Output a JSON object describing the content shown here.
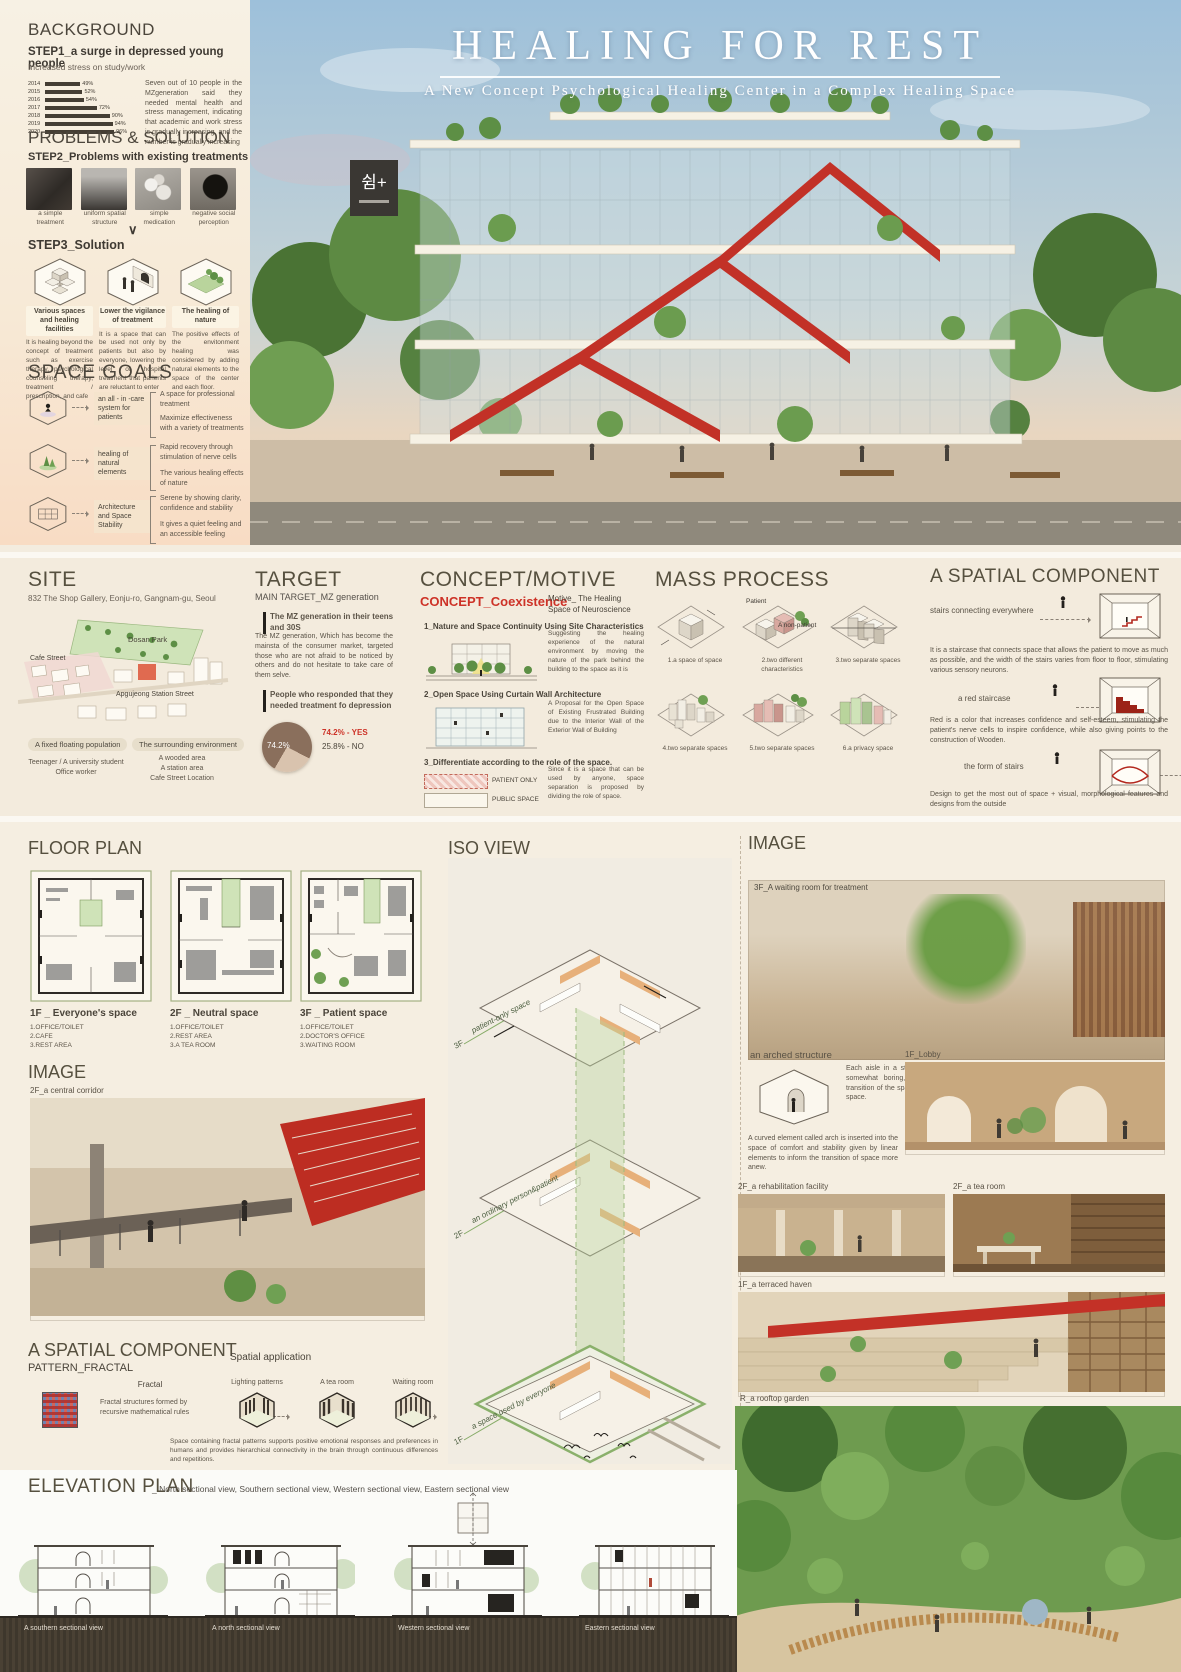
{
  "hero": {
    "title": "HEALING FOR REST",
    "subtitle": "A New Concept Psychological Healing Center in a Complex Healing Space",
    "sign_text": "쉼+"
  },
  "background": {
    "heading": "BACKGROUND",
    "step_title": "STEP1_a surge in depressed young people",
    "step_sub": "Increased stress on study/work",
    "body": "Seven out of 10 people in the MZgeneration said they needed mental health and stress management, indicating that academic and work stress is gradually increasing, and the number is gradually increasing",
    "chart": {
      "years": [
        "2014",
        "2015",
        "2016",
        "2017",
        "2018",
        "2019",
        "2020"
      ],
      "values": [
        "49%",
        "52%",
        "54%",
        "72%",
        "90%",
        "94%",
        "96%"
      ]
    }
  },
  "problems": {
    "heading": "PROBLEMS & SOLUTION",
    "step_title": "STEP2_Problems with existing treatments",
    "items": [
      {
        "label": "a simple treatment"
      },
      {
        "label": "uniform spatial structure"
      },
      {
        "label": "simple medication"
      },
      {
        "label": "negative social perception"
      }
    ]
  },
  "solution": {
    "step_title": "STEP3_Solution",
    "columns": [
      {
        "title": "Various spaces and healing facilities",
        "body": "It is healing beyond the concept of treatment such as exercise therapy, psychological counseling therapy, treatment / prescription, and cafe"
      },
      {
        "title": "Lower the vigilance of treatment",
        "body": "It is a space that can be used not only by patients but also by everyone, lowering the level of hospital treatment that parients are reluctant to enter"
      },
      {
        "title": "The healing of nature",
        "body": "The positive effects of the envitonment healing was considered by adding natural elements to the space of the center and each floor."
      }
    ]
  },
  "space_goals": {
    "heading": "SPACE GOALS",
    "rows": [
      {
        "label": "an all - in -care system for patients",
        "point1": "A space for professional treatment",
        "point2": "Maximize effectiveness with a variety of treatments"
      },
      {
        "label": "healing of natural elements",
        "point1": "Rapid recovery through stimulation of nerve cells",
        "point2": "The various healing effects of nature"
      },
      {
        "label": "Architecture and Space Stability",
        "point1": "Serene by showing clarity, confidence and stability",
        "point2": "It gives a quiet feeling and an accessible feeling"
      }
    ]
  },
  "site": {
    "heading": "SITE",
    "address": "832 The Shop Gallery, Eonju-ro, Gangnam-gu, Seoul",
    "map": {
      "park": "Dosan Park",
      "cafe": "Cafe Street",
      "station": "Apgujeong Station Street"
    },
    "tag1": "A fixed floating population",
    "tag2": "The surrounding environment",
    "note1": "Teenager / A university student Office worker",
    "note2": "A wooded area\nA station area\nCafe Street Location"
  },
  "target": {
    "heading": "TARGET",
    "sub": "MAIN TARGET_MZ generation",
    "point1": "The MZ generation in their teens and 30S",
    "body1": "The MZ generation, Which has become the mainsta of the consumer market, targeted those who are not afraid to be noticed by others and do not hesitate to take care of them selve.",
    "point2": "People who responded that they needed treatment fo depression",
    "pie": {
      "pct_label": "74.2%",
      "yes": "74.2% - YES",
      "no": "25.8% - NO"
    }
  },
  "concept": {
    "heading": "CONCEPT/MOTIVE",
    "concept_label": "CONCEPT_Coexistence",
    "motive_label": "Motive_ The Healing Space of Neuroscience",
    "item1_title": "1_Nature and Space Continuity Using Site Characteristics",
    "item1_body": "Suggesting the healing experience of the natural environment by moving the nature of the park behind the building to the space as it is",
    "item2_title": "2_Open Space Using Curtain Wall Architecture",
    "item2_body": "A Proposal for the Open Space of Existing Frustrated Building due to the Interior Wall of the Exterior Wall of Building",
    "item3_title": "3_Differentiate according to the role of the space.",
    "item3_body": "Since it is a space that can be used by anyone, space separation is proposed by dividing the role of space.",
    "item3_row1": "PATIENT ONLY",
    "item3_row2": "PUBLIC SPACE"
  },
  "mass": {
    "heading": "MASS PROCESS",
    "steps": [
      "1.a space of space",
      "2.two different characteristics",
      "3.two separate spaces",
      "4.two separate spaces",
      "5.two separate spaces",
      "6.a privacy space"
    ],
    "ann1": "Patient",
    "ann2": "A non-patient"
  },
  "spatial": {
    "heading": "A SPATIAL COMPONENT",
    "row1_label": "stairs connecting everywhere",
    "row1_body": "It is a staircase that connects space that allows the patient to move as much as possible, and the width of the stairs varies from floor to floor, stimulating various sensory neurons.",
    "row2_label": "a red staircase",
    "row2_body": "Red is a color that increases confidence and self-esteem, stimulating the patient's nerve cells to inspire confidence, while also giving points to the construction of Wooden.",
    "row3_label": "the form of stairs",
    "row3_body": "Design to get the most out of space + visual, morphological features and designs from the outside"
  },
  "floor_plan": {
    "heading": "FLOOR PLAN",
    "plans": [
      {
        "title": "1F _ Everyone's space",
        "rooms": "1.OFFICE/TOILET\n2.CAFE\n3.REST AREA"
      },
      {
        "title": "2F _ Neutral space",
        "rooms": "1.OFFICE/TOILET\n2.REST AREA\n3.A TEA ROOM"
      },
      {
        "title": "3F _ Patient space",
        "rooms": "1.OFFICE/TOILET\n2.DOCTOR'S OFFICE\n3.WAITING ROOM"
      }
    ]
  },
  "image_left": {
    "heading": "IMAGE",
    "caption": "2F_a central corridor"
  },
  "iso": {
    "heading": "ISO VIEW",
    "floors": [
      {
        "num": "3F",
        "label": "patient-only space"
      },
      {
        "num": "2F",
        "label": "an ordinary person&patient"
      },
      {
        "num": "1F",
        "label": "a space used by everyone"
      }
    ]
  },
  "fractal": {
    "heading": "A SPATIAL COMPONENT",
    "sub": "PATTERN_FRACTAL",
    "label": "Fractal",
    "desc": "Fractal structures formed by recursive mathematical rules",
    "app_title": "Spatial application",
    "apps": [
      "Lighting patterns",
      "A tea room",
      "Waiting room"
    ],
    "body": "Space containing fractal patterns supports positive emotional responses and preferences in humans and provides hierarchical connectivity in the brain through continuous differences and repetitions."
  },
  "image_right": {
    "heading": "IMAGE",
    "waiting": "3F_A waiting room for treatment",
    "arched": "an arched structure",
    "arched_body": "Each aisle in a straight space, which can be somewhat boring, is arched to inform the transition of the space and give a new sense of space.",
    "arched_body2": "A curved element called arch is inserted into the space of comfort and stability given by linear elements to inform the transition of space more anew.",
    "lobby": "1F_Lobby",
    "rehab": "2F_a rehabilitation facility",
    "tearoom": "2F_a tea room",
    "terraced": "1F_a terraced haven",
    "rooftop": "R_a rooftop garden"
  },
  "elevation": {
    "heading": "ELEVATION PLAN",
    "sub": "_ North sectional view, Southern sectional view, Western sectional view, Eastern sectional view",
    "captions": [
      "A southern sectional view",
      "A north sectional view",
      "Western sectional view",
      "Eastern sectional view"
    ]
  },
  "chart_data": [
    {
      "type": "bar",
      "title": "Increased stress on study/work",
      "categories": [
        "2014",
        "2015",
        "2016",
        "2017",
        "2018",
        "2019",
        "2020"
      ],
      "values": [
        49,
        52,
        54,
        72,
        90,
        94,
        96
      ],
      "xlabel": "year",
      "ylabel": "% reporting need for mental health care",
      "ylim": [
        0,
        100
      ]
    },
    {
      "type": "pie",
      "title": "People who responded that they needed treatment fo depression",
      "labels": [
        "YES",
        "NO"
      ],
      "values": [
        74.2,
        25.8
      ]
    }
  ]
}
